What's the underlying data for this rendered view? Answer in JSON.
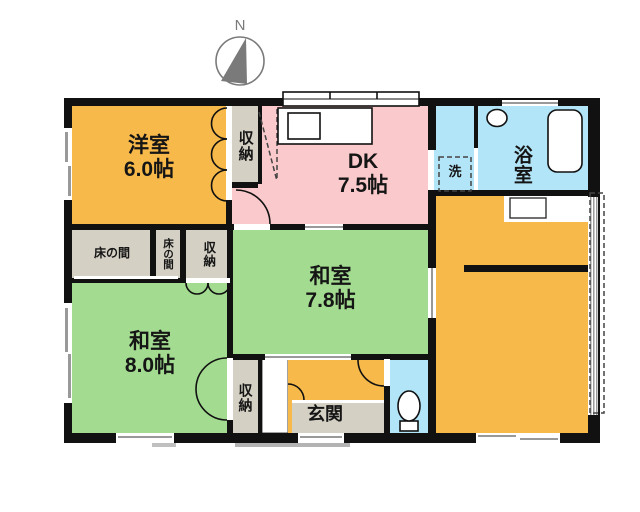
{
  "compass": {
    "label": "N"
  },
  "rooms": {
    "yoshitsu": {
      "name": "洋室",
      "size": "6.0帖"
    },
    "dk": {
      "name": "DK",
      "size": "7.5帖"
    },
    "washitsu78": {
      "name": "和室",
      "size": "7.8帖"
    },
    "washitsu80": {
      "name": "和室",
      "size": "8.0帖"
    },
    "bathroom": {
      "name": "浴室"
    },
    "laundry": {
      "name": "洗"
    },
    "genkan": {
      "name": "玄関"
    },
    "storage_top": {
      "name": "収納"
    },
    "storage_mid": {
      "name": "収納"
    },
    "storage_bottom": {
      "name": "収納"
    },
    "tokonoma_wide": {
      "name": "床の間"
    },
    "tokonoma_narrow": {
      "name": "床の間"
    }
  },
  "colors": {
    "western_room": "#F7B94A",
    "dining_kitchen": "#F9C9CB",
    "tatami_room": "#A3DC90",
    "wet_area": "#B2E5F7",
    "storage": "#D4D0C4",
    "wall": "#111111",
    "compass": "#7A7A7A"
  }
}
